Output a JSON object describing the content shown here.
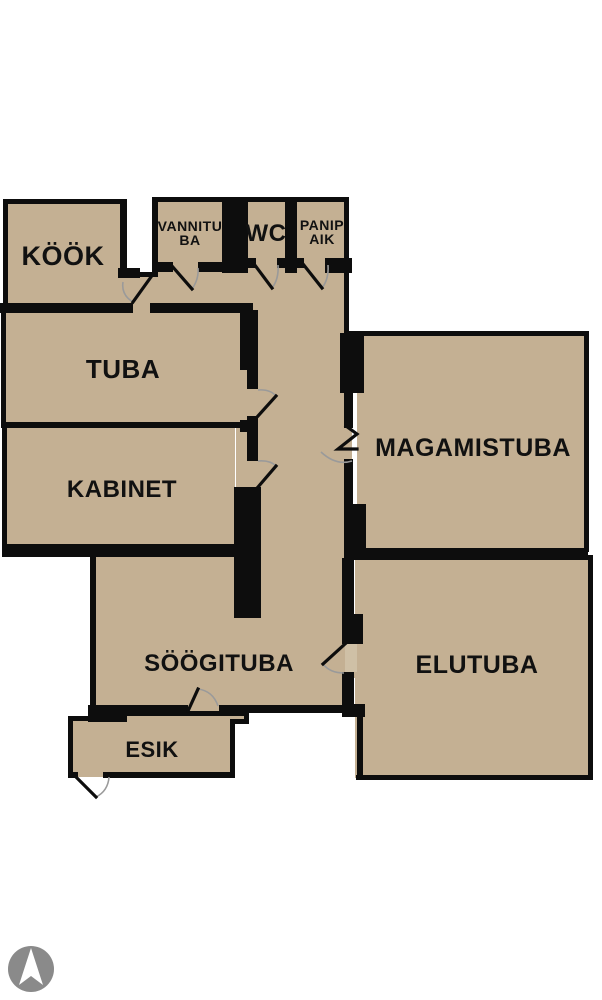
{
  "figure": {
    "type": "floor-plan",
    "description": "Apartment floor plan with Estonian room labels"
  },
  "rooms": {
    "kook": {
      "label": "KÖÖK"
    },
    "vannituba": {
      "label": "VANNITUBA",
      "line1": "VANNITU",
      "line2": "BA"
    },
    "wc": {
      "label": "WC"
    },
    "panipaik": {
      "label": "PANIPAIK",
      "line1": "PANIP",
      "line2": "AIK"
    },
    "tuba": {
      "label": "TUBA"
    },
    "kabinet": {
      "label": "KABINET"
    },
    "magamistuba": {
      "label": "MAGAMISTUBA"
    },
    "soogituba": {
      "label": "SÖÖGITUBA"
    },
    "elutuba": {
      "label": "ELUTUBA"
    },
    "esik": {
      "label": "ESIK"
    }
  },
  "colors": {
    "background": "#ffffff",
    "floor": "#c4b093",
    "wall": "#0d0d0d",
    "door_arc": "#9a9a9a",
    "door_panel": "#cfc0a6",
    "label": "#111111",
    "compass": "#8a8a8a",
    "compass_arrow": "#ffffff"
  },
  "compass": {
    "icon": "north-arrow"
  }
}
